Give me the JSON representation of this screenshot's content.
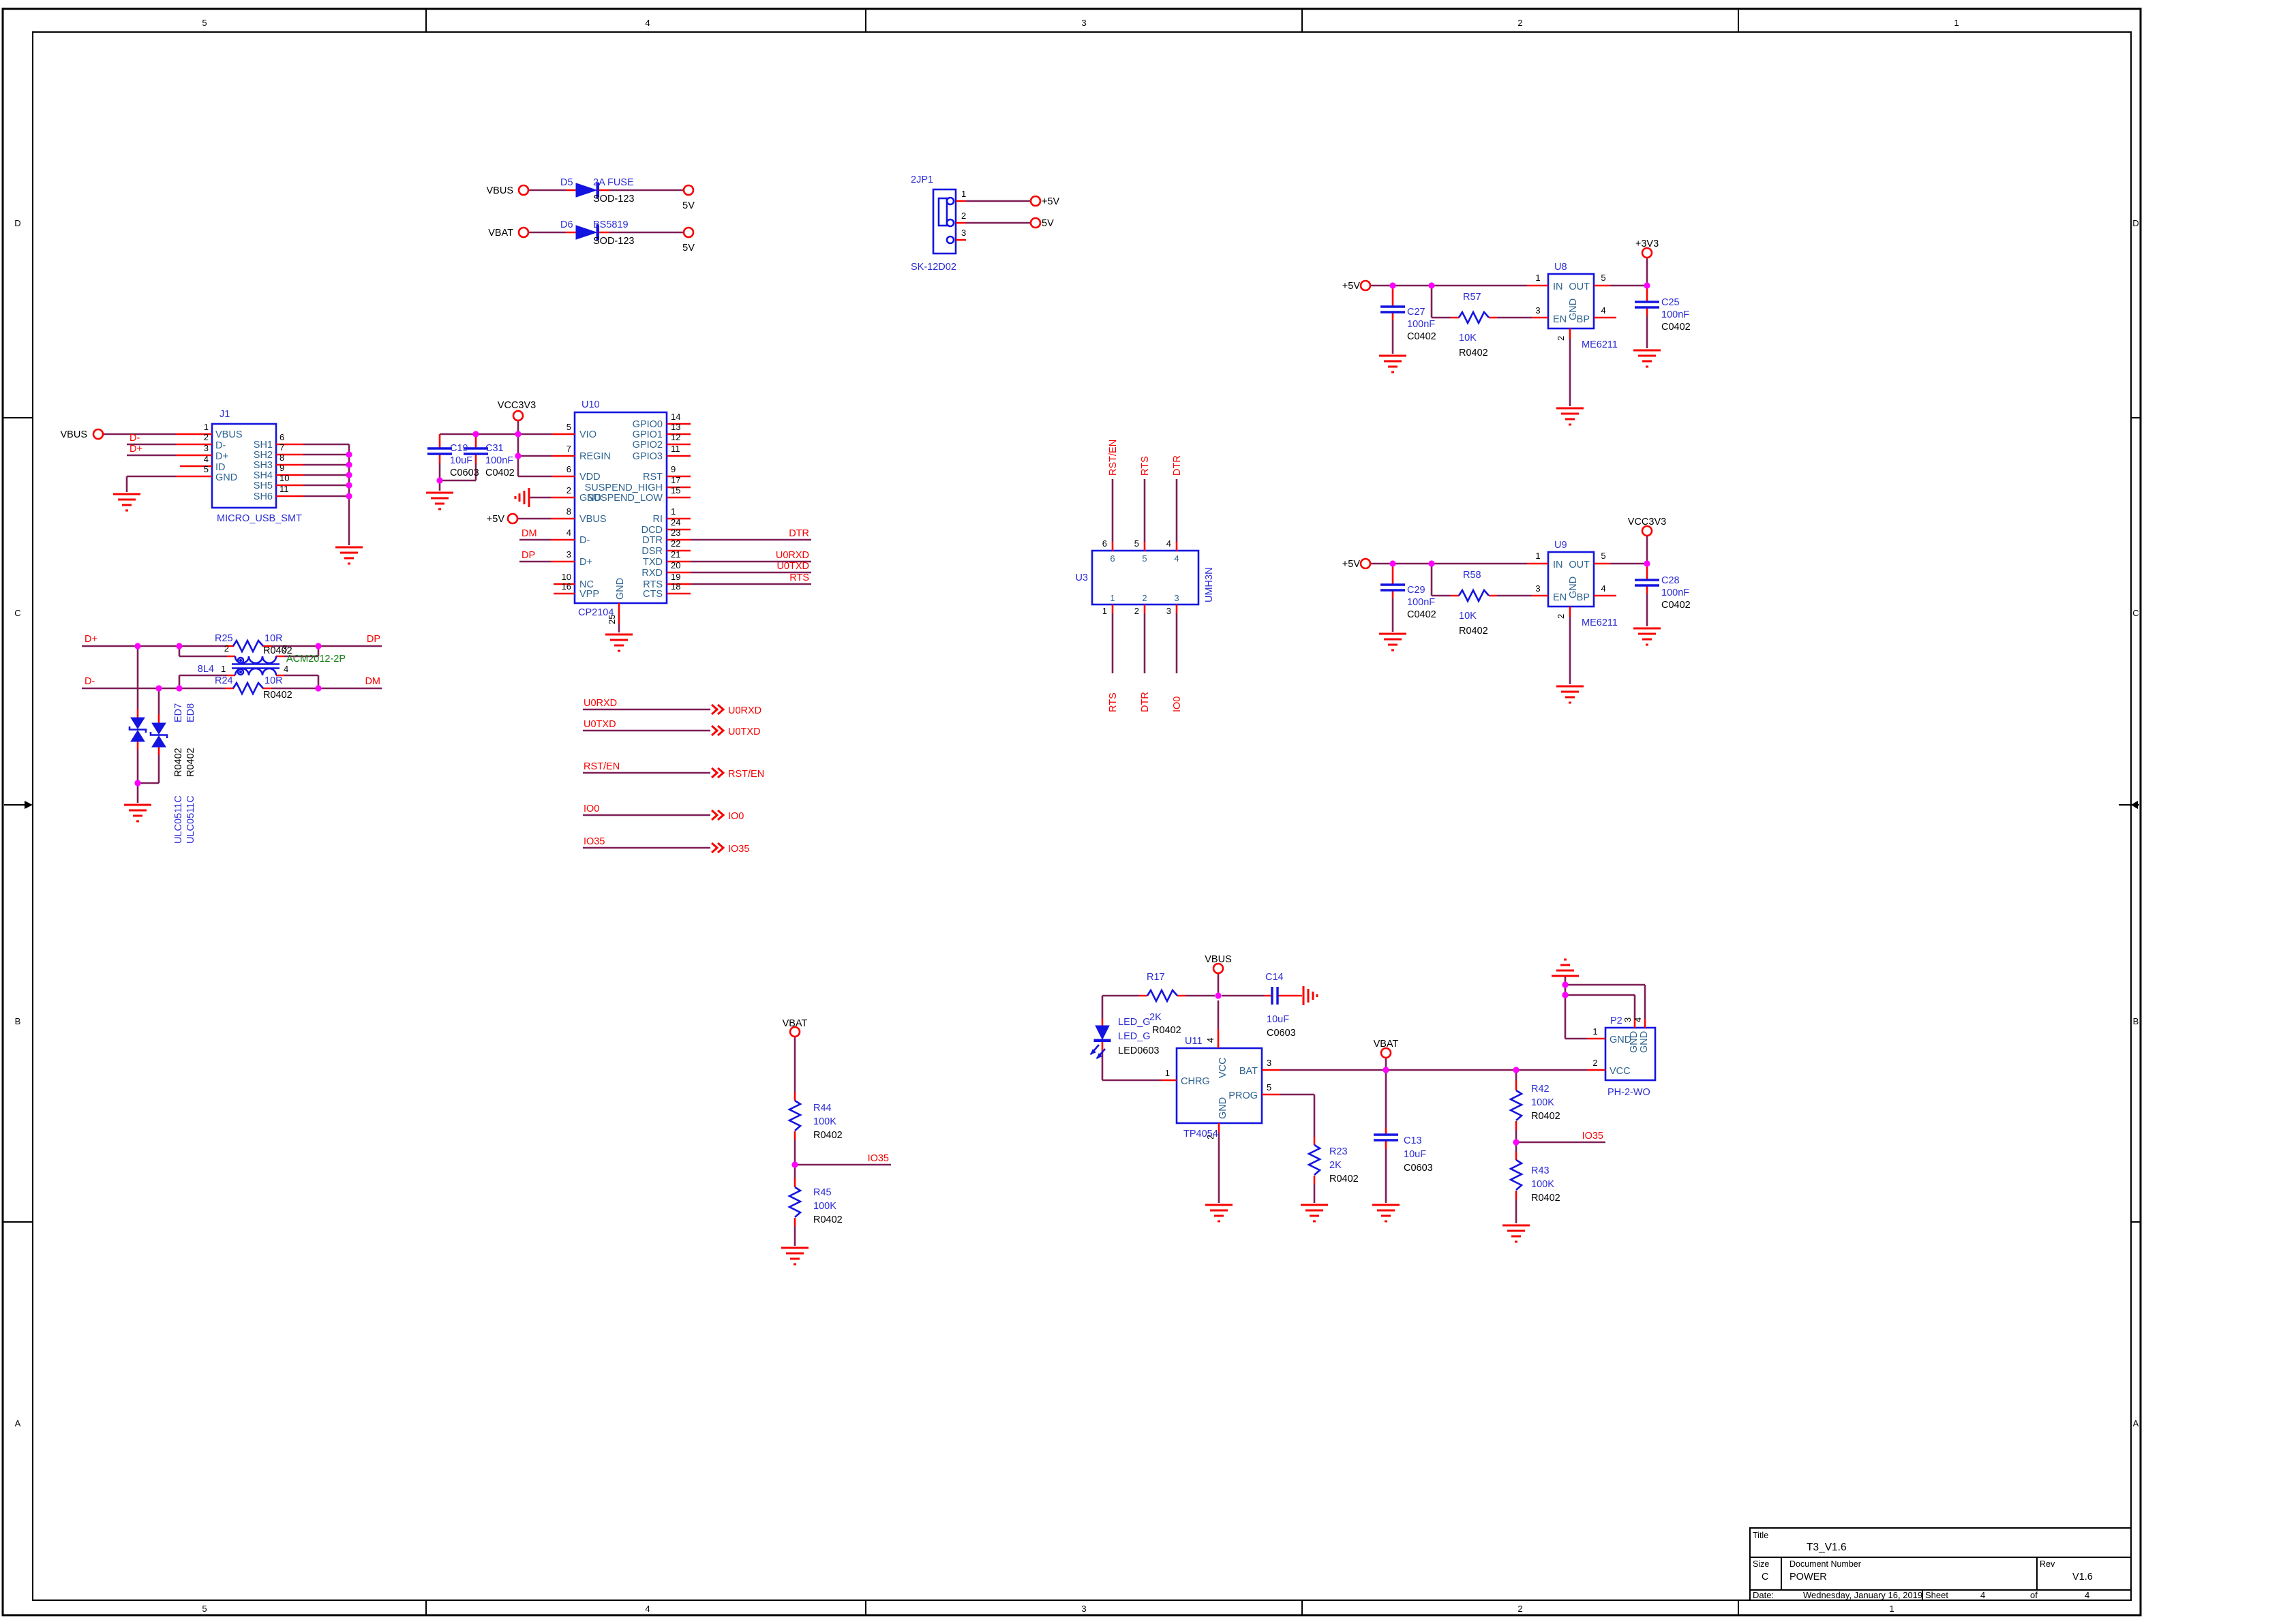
{
  "palette": {
    "wire": "#7E1E56",
    "stub": "#F80000",
    "part_outline": "#1414E0",
    "part_text": "#2B2BD5",
    "pin_name": "#2E6390",
    "net_label": "#F80000",
    "junction": "#FF00FF",
    "ground": "#F80000",
    "alt_value_green": "#0E7D0E",
    "black": "#000000"
  },
  "border": {
    "h_zones": [
      "5",
      "4",
      "3",
      "2",
      "1"
    ],
    "v_zones": [
      "D",
      "C",
      "B",
      "A"
    ]
  },
  "title_block": {
    "title_label": "Title",
    "title": "T3_V1.6",
    "size_label": "Size",
    "size": "C",
    "doc_label": "Document Number",
    "doc": "POWER",
    "rev_label": "Rev",
    "rev": "V1.6",
    "date_label": "Date:",
    "date": "Wednesday, January 16, 2019",
    "sheet_label": "Sheet",
    "sheet_page": "4",
    "of_label": "of",
    "sheet_total": "4"
  },
  "ports": {
    "vbus": "VBUS",
    "vbat": "VBAT",
    "p5v": "+5V",
    "v5": "5V",
    "p3v3": "+3V3",
    "vcc3v3": "VCC3V3"
  },
  "nets": {
    "dp_j": "D+",
    "dm_j": "D-",
    "dp": "DP",
    "dm": "DM",
    "dtr": "DTR",
    "u0rxd": "U0RXD",
    "u0txd": "U0TXD",
    "rts": "RTS",
    "rst_en": "RST/EN",
    "io0": "IO0",
    "io35": "IO35"
  },
  "components": {
    "d5": {
      "ref": "D5",
      "value": "2A FUSE",
      "fp": "SOD-123"
    },
    "d6": {
      "ref": "D6",
      "value": "BS5819",
      "fp": "SOD-123"
    },
    "jp1": {
      "ref": "2JP1",
      "value": "SK-12D02",
      "pins": [
        "1",
        "2",
        "3"
      ]
    },
    "j1": {
      "ref": "J1",
      "value": "MICRO_USB_SMT",
      "left_nums": [
        "1",
        "2",
        "3",
        "4",
        "5"
      ],
      "left_names": [
        "VBUS",
        "D-",
        "D+",
        "ID",
        "GND"
      ],
      "right_nums": [
        "6",
        "7",
        "8",
        "9",
        "10",
        "11"
      ],
      "right_names": [
        "SH1",
        "SH2",
        "SH3",
        "SH4",
        "SH5",
        "SH6"
      ]
    },
    "u10": {
      "ref": "U10",
      "value": "CP2104",
      "left_nums": [
        "5",
        "7",
        "6",
        "2",
        "8",
        "4",
        "3",
        "10",
        "16"
      ],
      "left_names": [
        "VIO",
        "REGIN",
        "VDD",
        "GND",
        "VBUS",
        "D-",
        "D+",
        "NC",
        "VPP"
      ],
      "right_nums": [
        "14",
        "13",
        "12",
        "11",
        "9",
        "17",
        "15",
        "1",
        "24",
        "23",
        "22",
        "21",
        "20",
        "19",
        "18"
      ],
      "right_names": [
        "GPIO0",
        "GPIO1",
        "GPIO2",
        "GPIO3",
        "RST",
        "SUSPEND_HIGH",
        "SUSPEND_LOW",
        "RI",
        "DCD",
        "DTR",
        "DSR",
        "TXD",
        "RXD",
        "RTS",
        "CTS"
      ],
      "bottom_num": "25",
      "bottom_name": "GND"
    },
    "u3": {
      "ref": "U3",
      "value": "UMH3N",
      "top_nums": [
        "6",
        "5",
        "4"
      ],
      "bottom_nums": [
        "1",
        "2",
        "3"
      ]
    },
    "u8": {
      "ref": "U8",
      "value": "ME6211",
      "nums": [
        "1",
        "5",
        "3",
        "4",
        "2"
      ],
      "names": [
        "IN",
        "OUT",
        "EN",
        "BP",
        "GND"
      ]
    },
    "u9": {
      "ref": "U9",
      "value": "ME6211",
      "nums": [
        "1",
        "5",
        "3",
        "4",
        "2"
      ],
      "names": [
        "IN",
        "OUT",
        "EN",
        "BP",
        "GND"
      ]
    },
    "u11": {
      "ref": "U11",
      "value": "TP4054",
      "nums": [
        "1",
        "4",
        "3",
        "5",
        "2"
      ],
      "names": [
        "CHRG",
        "VCC",
        "BAT",
        "PROG",
        "GND"
      ]
    },
    "p2": {
      "ref": "P2",
      "value": "PH-2-WO",
      "nums": [
        "1",
        "2",
        "3",
        "4"
      ],
      "names": [
        "GND",
        "VCC",
        "GND",
        "GND"
      ]
    },
    "r17": {
      "ref": "R17",
      "value": "2K",
      "fp": "R0402"
    },
    "r23": {
      "ref": "R23",
      "value": "2K",
      "fp": "R0402"
    },
    "r24": {
      "ref": "R24",
      "value": "10R",
      "fp": "R0402"
    },
    "r25": {
      "ref": "R25",
      "value": "10R",
      "fp": "R0402"
    },
    "r42": {
      "ref": "R42",
      "value": "100K",
      "fp": "R0402"
    },
    "r43": {
      "ref": "R43",
      "value": "100K",
      "fp": "R0402"
    },
    "r44": {
      "ref": "R44",
      "value": "100K",
      "fp": "R0402"
    },
    "r45": {
      "ref": "R45",
      "value": "100K",
      "fp": "R0402"
    },
    "r57": {
      "ref": "R57",
      "value": "10K",
      "fp": "R0402"
    },
    "r58": {
      "ref": "R58",
      "value": "10K",
      "fp": "R0402"
    },
    "c13": {
      "ref": "C13",
      "value": "10uF",
      "fp": "C0603"
    },
    "c14": {
      "ref": "C14",
      "value": "10uF",
      "fp": "C0603"
    },
    "c19": {
      "ref": "C19",
      "value": "10uF",
      "fp": "C0603"
    },
    "c25": {
      "ref": "C25",
      "value": "100nF",
      "fp": "C0402"
    },
    "c27": {
      "ref": "C27",
      "value": "100nF",
      "fp": "C0402"
    },
    "c28": {
      "ref": "C28",
      "value": "100nF",
      "fp": "C0402"
    },
    "c29": {
      "ref": "C29",
      "value": "100nF",
      "fp": "C0402"
    },
    "c31": {
      "ref": "C31",
      "value": "100nF",
      "fp": "C0402"
    },
    "l4": {
      "ref": "8L4",
      "value": "ACM2012-2P",
      "nums": [
        "2",
        "3",
        "1",
        "4"
      ]
    },
    "ed7": {
      "ref": "ED7",
      "fp": "R0402",
      "value": "ULC0511C"
    },
    "ed8": {
      "ref": "ED8",
      "fp": "R0402",
      "value": "ULC0511C"
    },
    "led": {
      "ref": "LED_G",
      "value": "LED_G",
      "fp": "LED0603"
    }
  }
}
